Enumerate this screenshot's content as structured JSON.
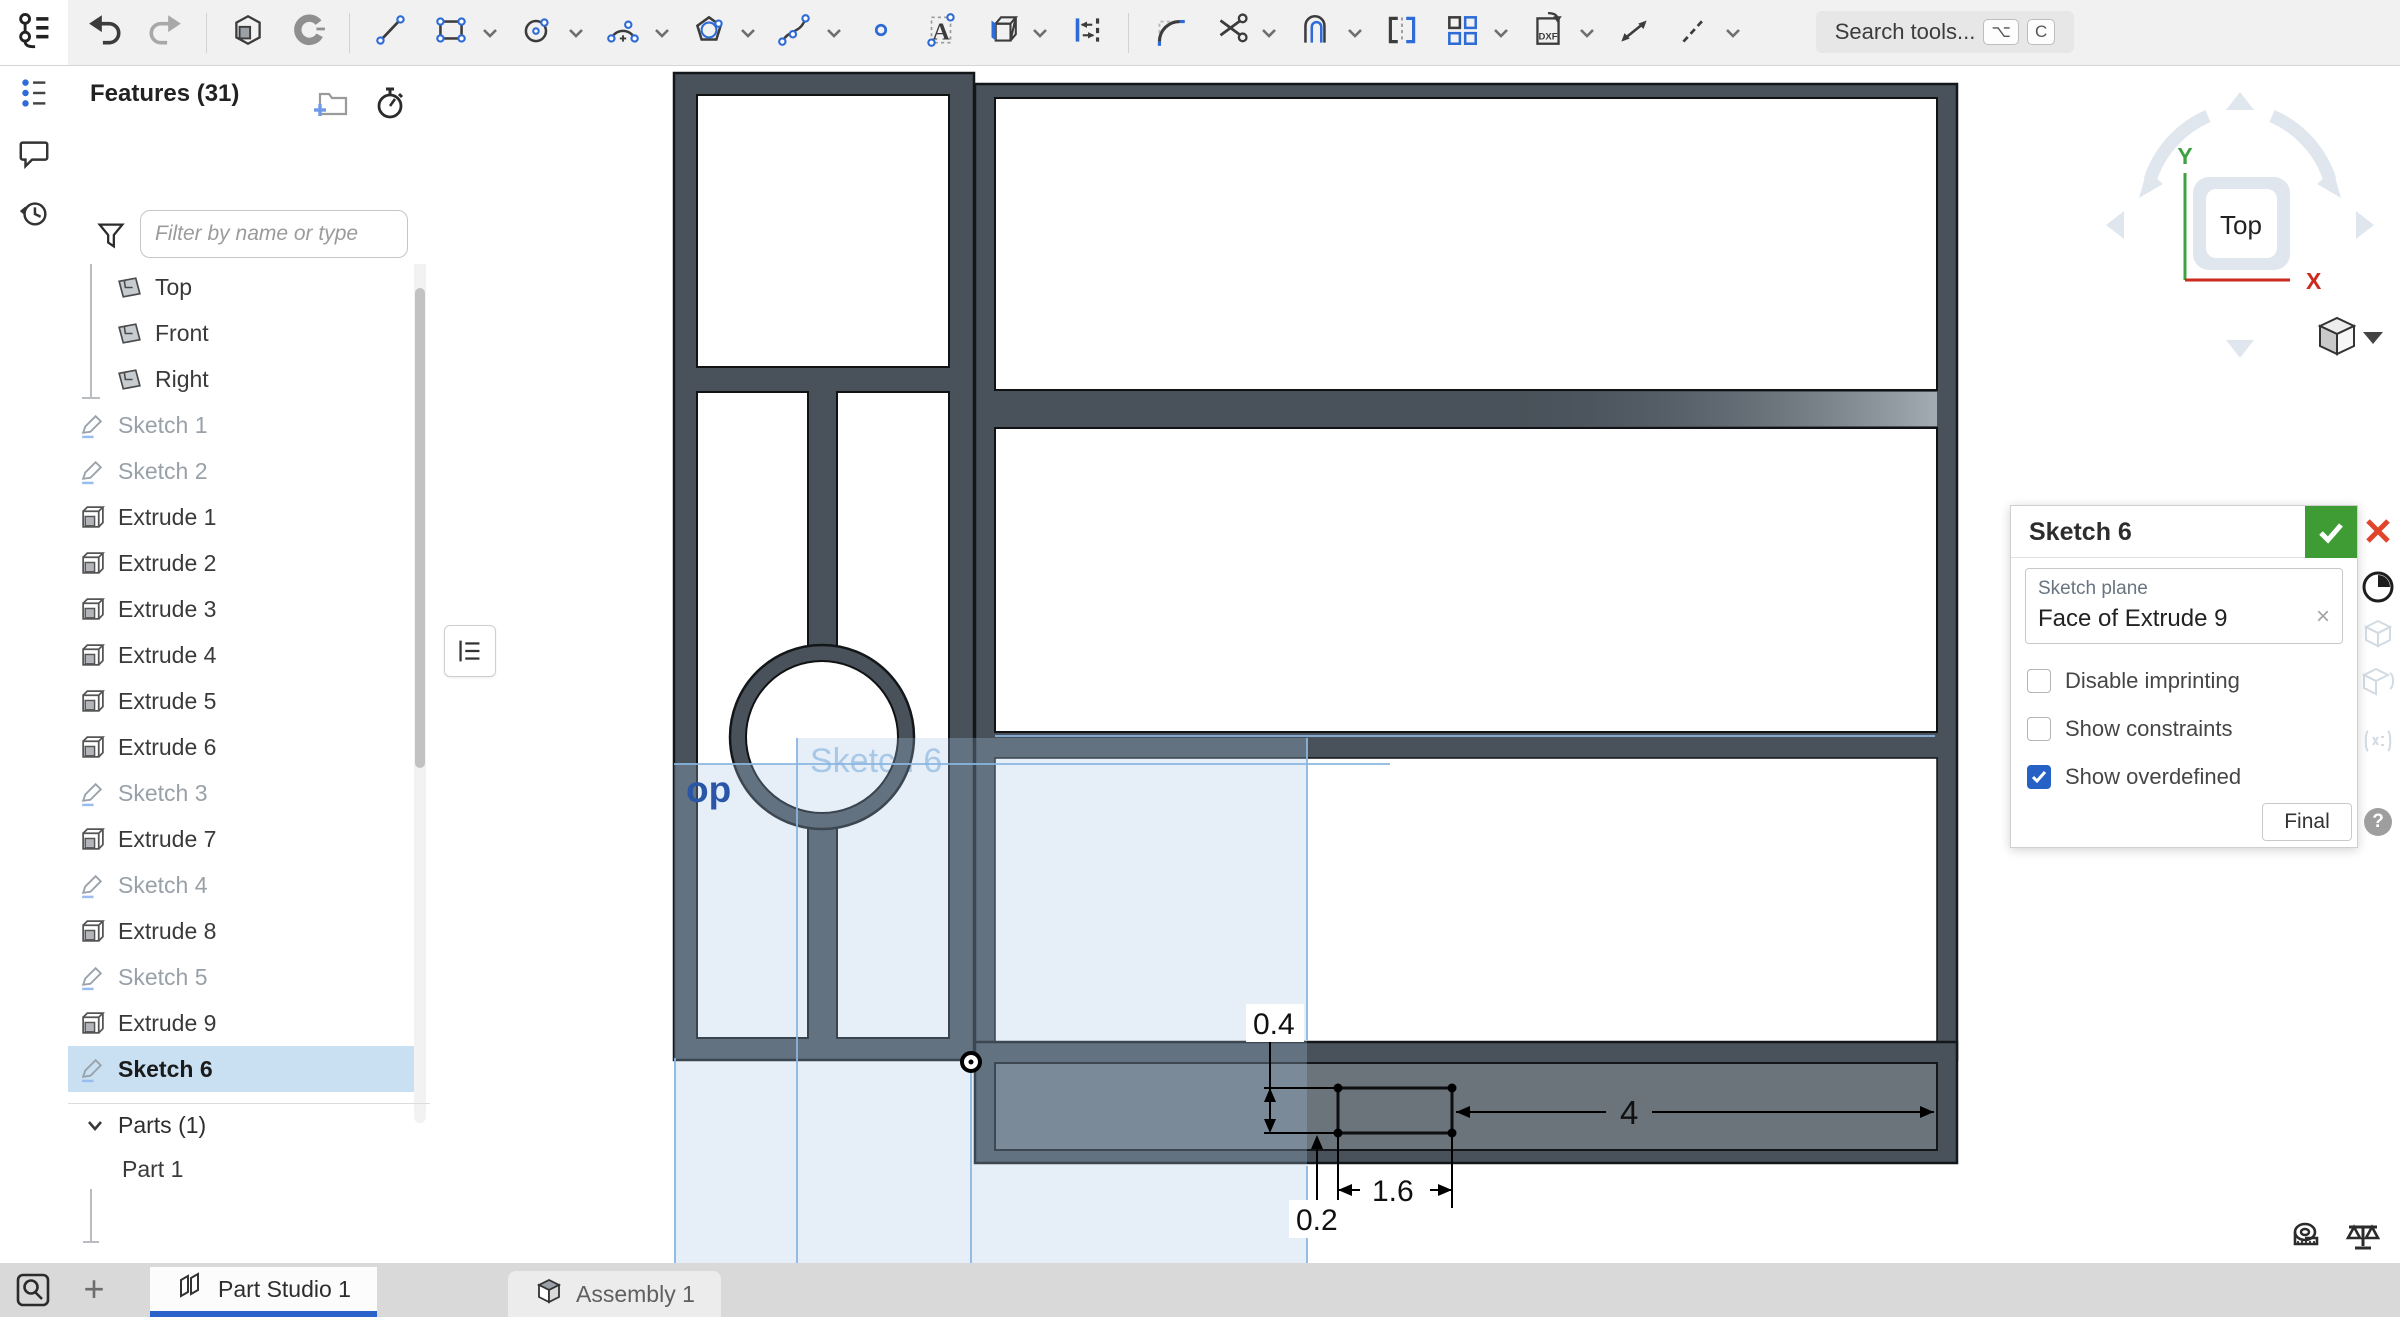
{
  "topbar": {
    "search_label": "Search tools...",
    "search_keys": [
      "⌥",
      "C"
    ],
    "tools": [
      {
        "icon": "undo"
      },
      {
        "icon": "redo"
      },
      {
        "sep": true
      },
      {
        "icon": "extrude"
      },
      {
        "icon": "revolve"
      },
      {
        "sep": true
      },
      {
        "icon": "line"
      },
      {
        "icon": "corner-rectangle",
        "dropdown": true
      },
      {
        "icon": "circle",
        "dropdown": true
      },
      {
        "icon": "arc",
        "dropdown": true
      },
      {
        "icon": "polygon",
        "dropdown": true
      },
      {
        "icon": "spline",
        "dropdown": true
      },
      {
        "icon": "point"
      },
      {
        "icon": "text"
      },
      {
        "icon": "use-project",
        "dropdown": true
      },
      {
        "icon": "offset-dimension"
      },
      {
        "sep": true
      },
      {
        "icon": "fillet"
      },
      {
        "icon": "trim",
        "dropdown": true
      },
      {
        "icon": "offset-entity",
        "dropdown": true
      },
      {
        "icon": "mirror"
      },
      {
        "icon": "pattern",
        "dropdown": true
      },
      {
        "icon": "dxf-import",
        "dropdown": true
      },
      {
        "icon": "dimension"
      },
      {
        "icon": "construction",
        "dropdown": true
      }
    ]
  },
  "features_panel": {
    "title": "Features (31)",
    "filter_placeholder": "Filter by name or type",
    "items": [
      {
        "label": "Origin",
        "type": "plane",
        "indent": true
      },
      {
        "label": "Top",
        "type": "plane",
        "indent": true
      },
      {
        "label": "Front",
        "type": "plane",
        "indent": true
      },
      {
        "label": "Right",
        "type": "plane",
        "indent": true
      },
      {
        "label": "Sketch 1",
        "type": "sketch",
        "muted": true
      },
      {
        "label": "Sketch 2",
        "type": "sketch",
        "muted": true
      },
      {
        "label": "Extrude 1",
        "type": "extrude"
      },
      {
        "label": "Extrude 2",
        "type": "extrude"
      },
      {
        "label": "Extrude 3",
        "type": "extrude"
      },
      {
        "label": "Extrude 4",
        "type": "extrude"
      },
      {
        "label": "Extrude 5",
        "type": "extrude"
      },
      {
        "label": "Extrude 6",
        "type": "extrude"
      },
      {
        "label": "Sketch 3",
        "type": "sketch",
        "muted": true
      },
      {
        "label": "Extrude 7",
        "type": "extrude"
      },
      {
        "label": "Sketch 4",
        "type": "sketch",
        "muted": true
      },
      {
        "label": "Extrude 8",
        "type": "extrude"
      },
      {
        "label": "Sketch 5",
        "type": "sketch",
        "muted": true
      },
      {
        "label": "Extrude 9",
        "type": "extrude"
      },
      {
        "label": "Sketch 6",
        "type": "sketch",
        "selected": true
      }
    ],
    "parts_header": "Parts (1)",
    "parts": [
      "Part 1"
    ]
  },
  "dialog": {
    "title": "Sketch 6",
    "plane_label": "Sketch plane",
    "plane_value": "Face of Extrude 9",
    "checkboxes": [
      {
        "label": "Disable imprinting",
        "checked": false
      },
      {
        "label": "Show constraints",
        "checked": false
      },
      {
        "label": "Show overdefined",
        "checked": true
      }
    ],
    "final_label": "Final",
    "help_label": "?"
  },
  "viewcube": {
    "face_label": "Top",
    "axis_y": "Y",
    "axis_x": "X"
  },
  "viewport": {
    "sketch_label": "Sketch 6",
    "clipped_plane_label": "op",
    "dimensions": {
      "height": "0.4",
      "lower": "0.2",
      "width": "1.6",
      "right_offset": "4"
    }
  },
  "tabs": {
    "add_label": "+",
    "items": [
      {
        "label": "Part Studio 1",
        "icon": "part-studio",
        "active": true
      },
      {
        "label": "Assembly 1",
        "icon": "assembly",
        "active": false
      }
    ]
  },
  "colors": {
    "accent_blue": "#2b62c9",
    "selection_blue": "#c9dff2",
    "confirm_green": "#3f9c35",
    "cancel_red": "#e0452c",
    "checkbox_blue": "#2662c5",
    "part_dark": "#49525a",
    "part_channel": "#6b737b",
    "sketch_line_blue": "#8ab6e0"
  }
}
